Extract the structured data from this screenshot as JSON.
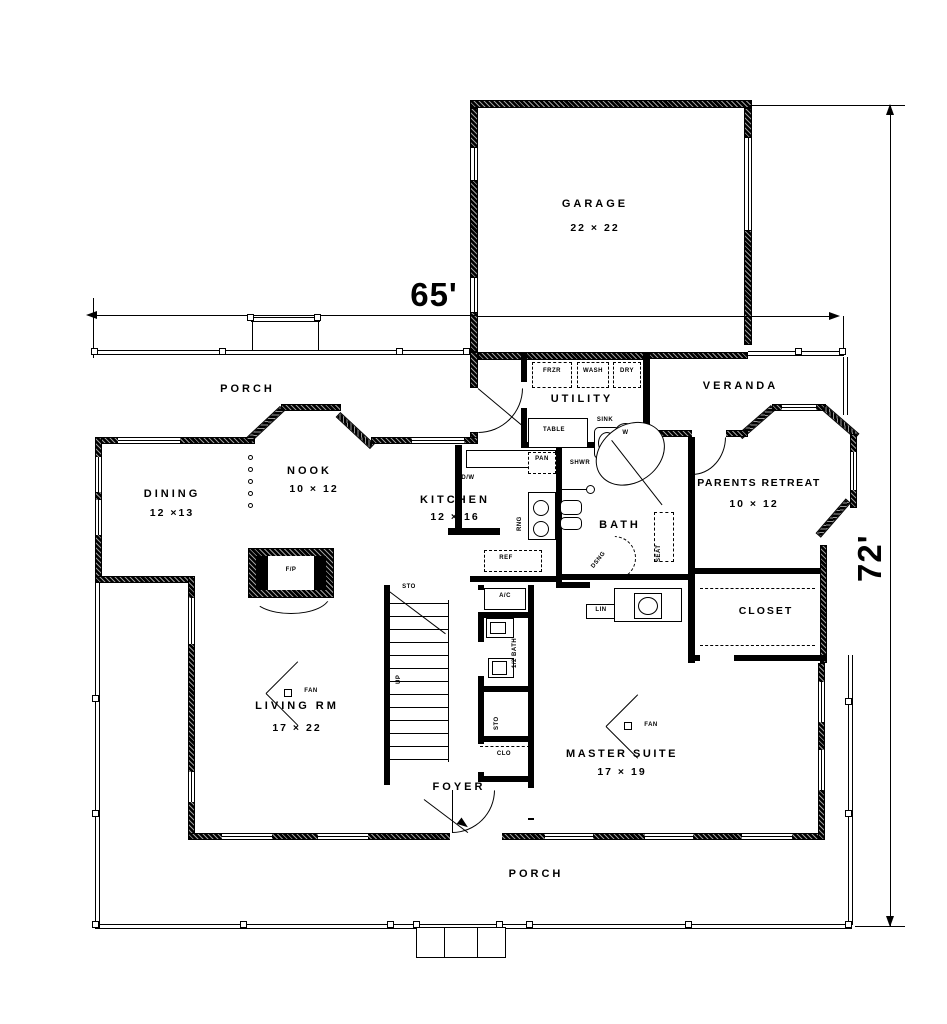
{
  "dimensions": {
    "width_label": "65'",
    "height_label": "72'"
  },
  "rooms": {
    "garage": {
      "name": "GARAGE",
      "size": "22 × 22"
    },
    "porch_top": {
      "name": "PORCH"
    },
    "veranda": {
      "name": "VERANDA"
    },
    "utility": {
      "name": "UTILITY"
    },
    "nook": {
      "name": "NOOK",
      "size": "10 × 12"
    },
    "dining": {
      "name": "DINING",
      "size": "12 ×13"
    },
    "kitchen": {
      "name": "KITCHEN",
      "size": "12 × 16"
    },
    "bath": {
      "name": "BATH"
    },
    "parents_retreat": {
      "name": "PARENTS RETREAT",
      "size": "10 × 12"
    },
    "closet": {
      "name": "CLOSET"
    },
    "living": {
      "name": "LIVING RM",
      "size": "17 × 22"
    },
    "master": {
      "name": "MASTER SUITE",
      "size": "17 × 19"
    },
    "foyer": {
      "name": "FOYER"
    },
    "porch_bottom": {
      "name": "PORCH"
    }
  },
  "fixtures": {
    "frzr": "FRZR",
    "wash": "WASH",
    "dry": "DRY",
    "table": "TABLE",
    "sink": "SINK",
    "water_heater": "W",
    "pan": "PAN",
    "shwr": "SHWR",
    "rng": "RNG",
    "ref": "REF",
    "dw": "D/W",
    "fp": "F/P",
    "ac": "A/C",
    "half_bath": "1/2 BATH",
    "sto_stairs": "STO",
    "sto_closet": "STO",
    "clo": "CLO",
    "lin": "LIN",
    "seat": "SEAT",
    "dsng": "DSNG",
    "up": "UP",
    "fan_living": "FAN",
    "fan_master": "FAN"
  },
  "colors": {
    "ink": "#000000",
    "paper": "#ffffff"
  }
}
